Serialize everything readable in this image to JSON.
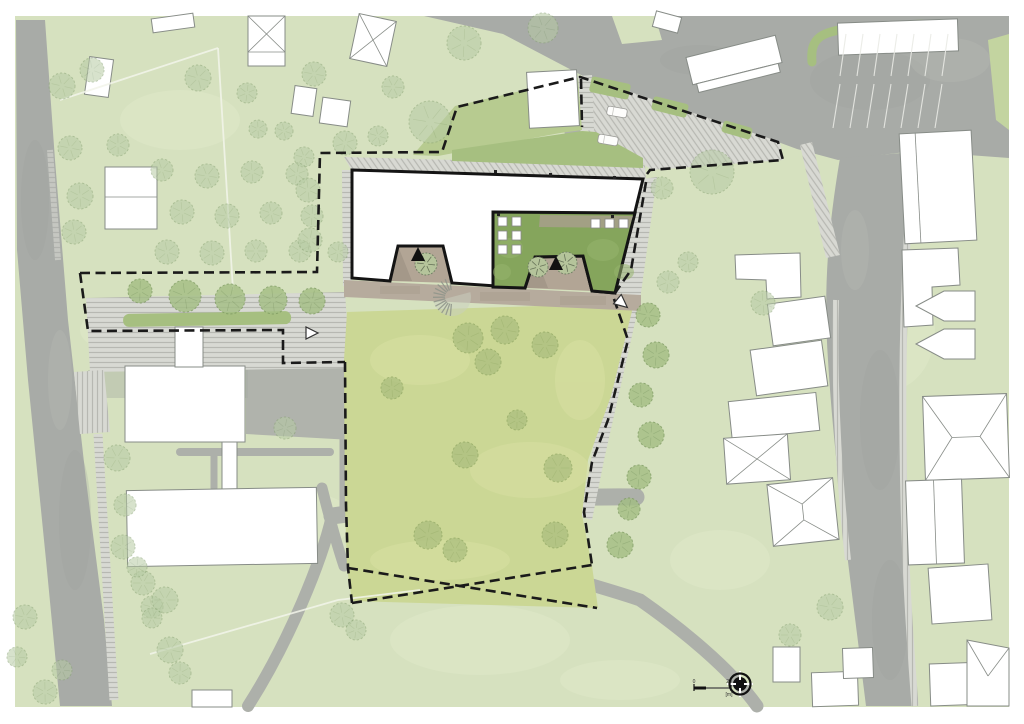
{
  "page": {
    "type": "architectural site plan",
    "background": "#ffffff"
  },
  "colors": {
    "grass": "#d6e1bf",
    "meadow": "#cbd795",
    "road": "#a8aba7",
    "path": "#adb0aa",
    "plaza": "#b0b3ac",
    "hatch_base": "#d8d9d3",
    "hatch_line": "#b7b8b2",
    "green_strip": "#a6bf80",
    "green_wedge": "#b7cb90",
    "courtyard_green": "#85a55c",
    "terrace": "#b6ab9d",
    "court_floor": "#b2a595",
    "building_fill": "#ffffff",
    "building_outline": "#141414",
    "context_outline": "#878c87",
    "boundary": "#1a1a1a",
    "tree_context": "#b7cba4",
    "tree_street": "#a3be83",
    "tree_meadow": "#a8bc7d",
    "white_line": "#f2f4ea"
  },
  "scale_bar": {
    "start_label": "0",
    "end_label": "20",
    "unit_label": "[m]"
  },
  "trees": {
    "context": [
      [
        62,
        86,
        13
      ],
      [
        92,
        70,
        12
      ],
      [
        198,
        78,
        13
      ],
      [
        247,
        93,
        10
      ],
      [
        314,
        74,
        12
      ],
      [
        118,
        145,
        11
      ],
      [
        70,
        148,
        12
      ],
      [
        80,
        196,
        13
      ],
      [
        74,
        232,
        12
      ],
      [
        258,
        129,
        9
      ],
      [
        284,
        131,
        9
      ],
      [
        304,
        157,
        10
      ],
      [
        162,
        170,
        11
      ],
      [
        207,
        176,
        12
      ],
      [
        252,
        172,
        11
      ],
      [
        297,
        174,
        11
      ],
      [
        182,
        212,
        12
      ],
      [
        227,
        216,
        12
      ],
      [
        271,
        213,
        11
      ],
      [
        312,
        216,
        11
      ],
      [
        167,
        252,
        12
      ],
      [
        212,
        253,
        12
      ],
      [
        256,
        251,
        11
      ],
      [
        300,
        251,
        11
      ],
      [
        338,
        252,
        10
      ],
      [
        345,
        143,
        12
      ],
      [
        378,
        136,
        10
      ],
      [
        308,
        190,
        12
      ],
      [
        310,
        240,
        12
      ],
      [
        393,
        87,
        11
      ],
      [
        464,
        43,
        17
      ],
      [
        543,
        28,
        15
      ],
      [
        430,
        122,
        21
      ],
      [
        712,
        172,
        22
      ],
      [
        662,
        188,
        11
      ],
      [
        668,
        282,
        11
      ],
      [
        688,
        262,
        10
      ],
      [
        763,
        303,
        12
      ],
      [
        830,
        607,
        13
      ],
      [
        790,
        635,
        11
      ],
      [
        117,
        458,
        13
      ],
      [
        123,
        547,
        12
      ],
      [
        143,
        583,
        12
      ],
      [
        152,
        607,
        11
      ],
      [
        170,
        650,
        13
      ],
      [
        180,
        673,
        11
      ],
      [
        137,
        567,
        10
      ],
      [
        125,
        505,
        11
      ],
      [
        25,
        617,
        12
      ],
      [
        17,
        657,
        10
      ],
      [
        45,
        692,
        12
      ],
      [
        62,
        670,
        10
      ],
      [
        285,
        428,
        11
      ],
      [
        165,
        600,
        13
      ],
      [
        152,
        618,
        10
      ],
      [
        342,
        615,
        12
      ],
      [
        356,
        630,
        10
      ]
    ],
    "street": [
      [
        140,
        291,
        12
      ],
      [
        185,
        296,
        16
      ],
      [
        230,
        299,
        15
      ],
      [
        273,
        300,
        14
      ],
      [
        312,
        301,
        13
      ],
      [
        648,
        315,
        12
      ],
      [
        656,
        355,
        13
      ],
      [
        641,
        395,
        12
      ],
      [
        651,
        435,
        13
      ],
      [
        639,
        477,
        12
      ],
      [
        629,
        509,
        11
      ],
      [
        620,
        545,
        13
      ]
    ],
    "meadow": [
      [
        468,
        338,
        15
      ],
      [
        505,
        330,
        14
      ],
      [
        488,
        362,
        13
      ],
      [
        545,
        345,
        13
      ],
      [
        392,
        388,
        11
      ],
      [
        465,
        455,
        13
      ],
      [
        558,
        468,
        14
      ],
      [
        428,
        535,
        14
      ],
      [
        455,
        550,
        12
      ],
      [
        555,
        535,
        13
      ],
      [
        517,
        420,
        10
      ]
    ],
    "courtyard": [
      [
        426,
        264,
        11
      ],
      [
        538,
        267,
        10
      ],
      [
        566,
        263,
        11
      ]
    ]
  },
  "parking": {
    "car_count": 2,
    "stall_rows": [
      {
        "x0": 846,
        "y0": 34,
        "y1": 76,
        "dx": 17,
        "count": 7,
        "slant": -6
      },
      {
        "x0": 840,
        "y0": 84,
        "y1": 128,
        "dx": 17,
        "count": 7,
        "slant": -7
      }
    ]
  }
}
